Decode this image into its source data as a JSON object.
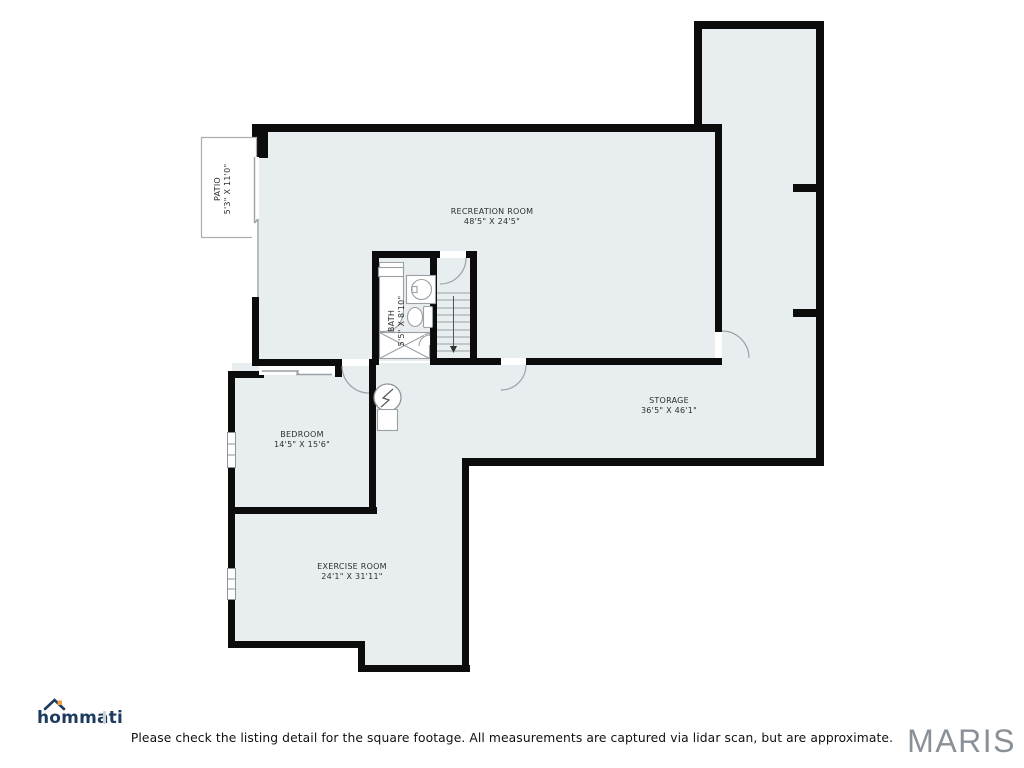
{
  "rooms": {
    "recreation": {
      "name": "RECREATION ROOM",
      "dims": "48'5\" X 24'5\""
    },
    "patio": {
      "name": "PATIO",
      "dims": "5'3\" X 11'0\""
    },
    "bath": {
      "name": "BATH",
      "dims": "5'5\" X 8'10\""
    },
    "bedroom": {
      "name": "BEDROOM",
      "dims": "14'5\" X 15'6\""
    },
    "storage": {
      "name": "STORAGE",
      "dims": "36'5\" X 46'1\""
    },
    "exercise": {
      "name": "EXERCISE ROOM",
      "dims": "24'1\" X 31'11\""
    }
  },
  "stairs": {
    "direction": "down-arrow"
  },
  "branding": {
    "logo_text": "hommati",
    "mls_text": "MARIS"
  },
  "footer": {
    "disclaimer": "Please check the listing detail for the square footage. All measurements are captured via lidar scan, but are approximate."
  },
  "colors": {
    "floor_fill": "#e8edf0",
    "wall": "#0c0c0c",
    "fixture_line": "#9aa0a5",
    "logo_navy": "#1d3a5f",
    "logo_orange": "#ef9f3d",
    "mls_gray": "#8a9098"
  }
}
